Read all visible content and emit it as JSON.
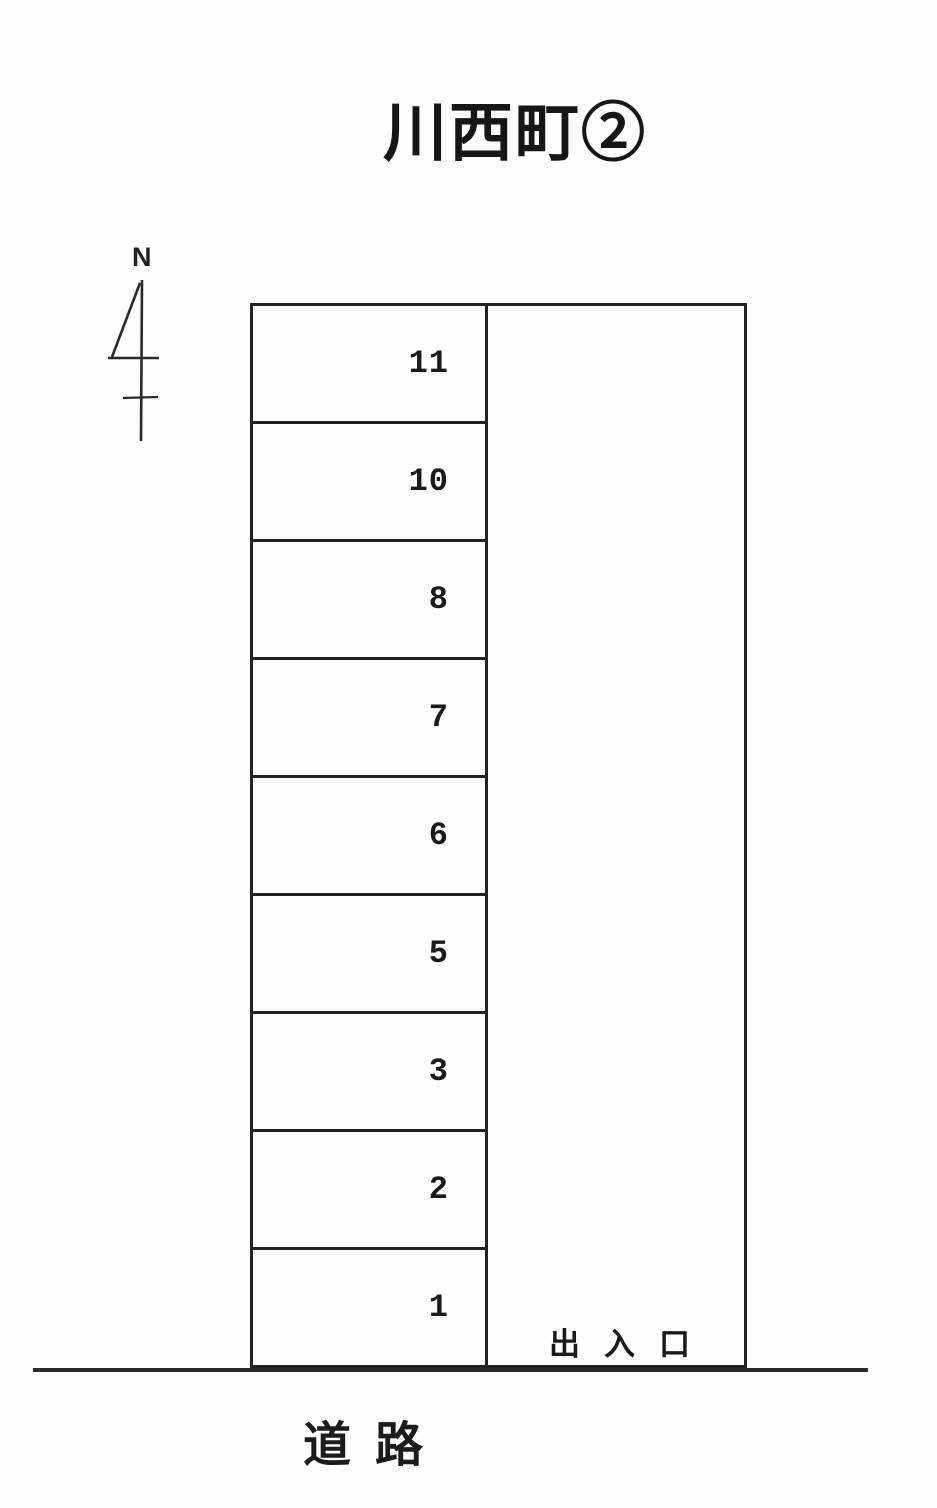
{
  "title": "川西町②",
  "compass": {
    "north_label": "N"
  },
  "parking": {
    "stalls": [
      {
        "number": "11"
      },
      {
        "number": "10"
      },
      {
        "number": "8"
      },
      {
        "number": "7"
      },
      {
        "number": "6"
      },
      {
        "number": "5"
      },
      {
        "number": "3"
      },
      {
        "number": "2"
      },
      {
        "number": "1"
      }
    ],
    "entrance_label": "出入口",
    "road_label": "道路"
  },
  "colors": {
    "line": "#222222",
    "text": "#1a1a1a",
    "background": "#fdfdfc"
  }
}
